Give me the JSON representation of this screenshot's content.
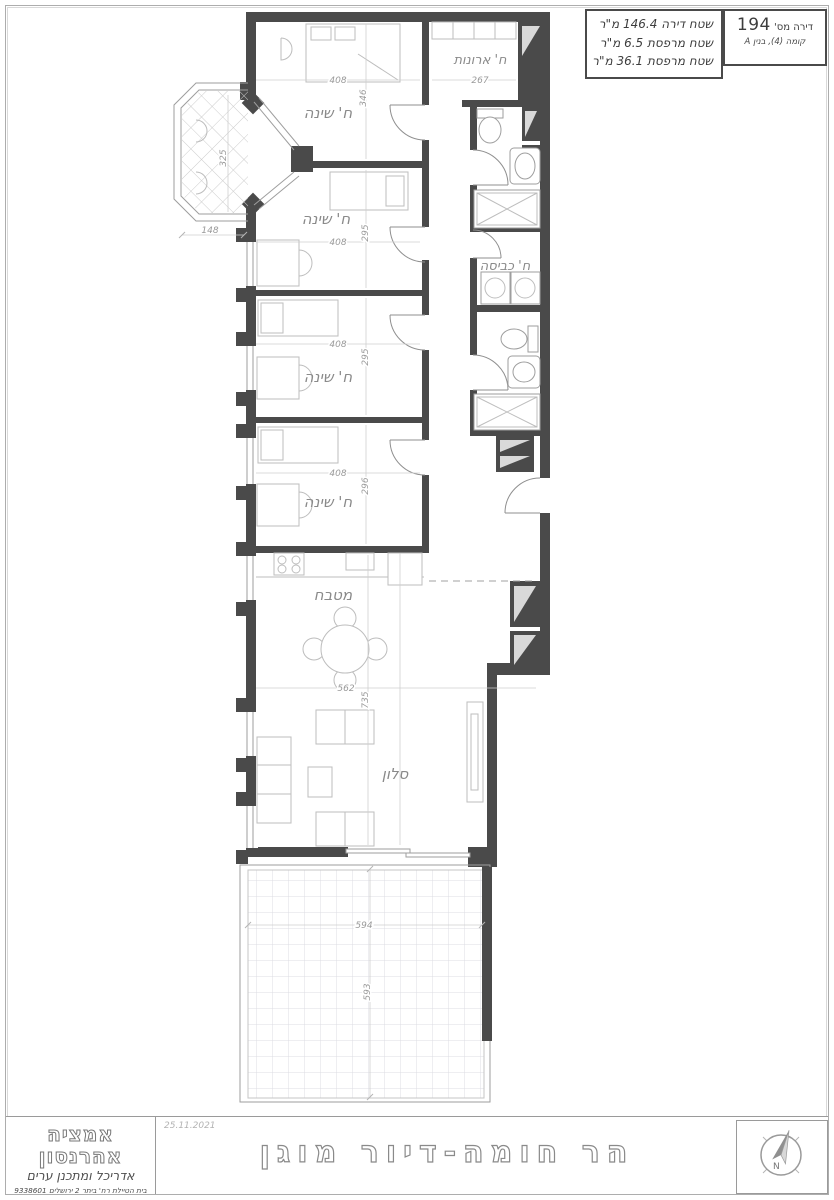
{
  "header": {
    "unit_label": "דירה מס'",
    "unit_number": "194",
    "floor_building": "קומה (4), בנין A",
    "area_lines": [
      "שטח דירה 146.4 מ\"ר",
      "שטח מרפסת 6.5 מ\"ר",
      "שטח מרפסת 36.1 מ\"ר"
    ]
  },
  "plan": {
    "room_labels": {
      "bedroom": "ח' שינה",
      "closet": "ח' ארונות",
      "laundry": "ח' כביסה",
      "kitchen": "מטבח",
      "living_room": "סלון"
    },
    "dims": {
      "bedroom1_w": "408",
      "bedroom1_h": "346",
      "bedroom2_w": "408",
      "bedroom2_h": "295",
      "bedroom3_w": "408",
      "bedroom3_h": "295",
      "bedroom4_w": "408",
      "bedroom4_h": "296",
      "closet_w": "267",
      "kitchen_w": "562",
      "kitchen_living_h": "735",
      "terrace_w": "594",
      "terrace_h": "593",
      "balcony_w": "148",
      "balcony_h": "325"
    }
  },
  "title_block": {
    "firm_name": "אמציה אהרנסון",
    "firm_role": "אדריכל ומתכנן ערים",
    "address_line": "בית הטיילת רח' ביתר 2 ירושלים 9338601",
    "phone_line": "טל. 02-6734494 פקס. 02-6734493",
    "email_line": "דוא\"ל : office@aaronson-arc.com",
    "date": "25.11.2021",
    "project_title": "הר חומה-דיור מוגן"
  },
  "compass": {
    "north": "N"
  }
}
